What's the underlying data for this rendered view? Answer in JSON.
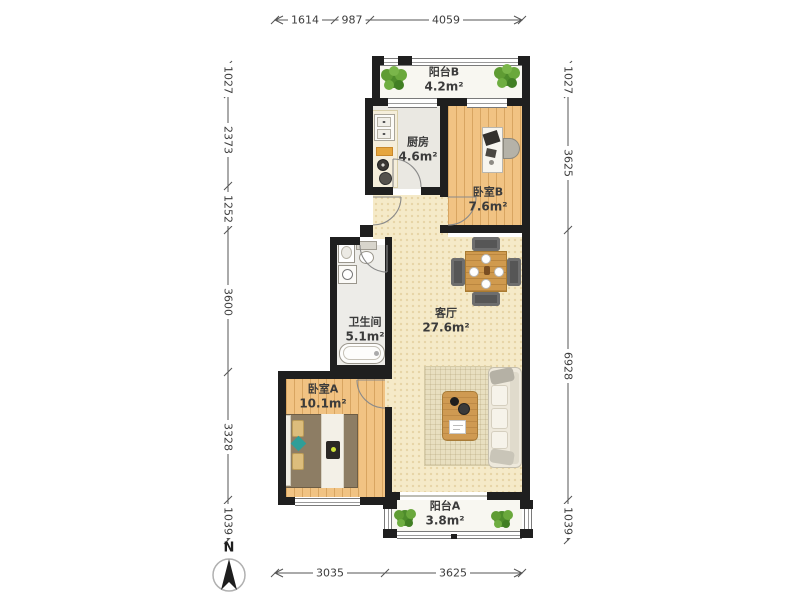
{
  "compass": {
    "label": "N"
  },
  "dimensions": {
    "top": [
      "1614",
      "987",
      "4059"
    ],
    "bottom": [
      "3035",
      "3625"
    ],
    "left": [
      "1027",
      "2373",
      "1252",
      "3600",
      "3328",
      "1039"
    ],
    "right": [
      "1027",
      "3625",
      "6928",
      "1039"
    ]
  },
  "rooms": {
    "balcony_b": {
      "name": "阳台B",
      "area": "4.2m²"
    },
    "kitchen": {
      "name": "厨房",
      "area": "4.6m²"
    },
    "bedroom_b": {
      "name": "卧室B",
      "area": "7.6m²"
    },
    "living_room": {
      "name": "客厅",
      "area": "27.6m²"
    },
    "bathroom": {
      "name": "卫生间",
      "area": "5.1m²"
    },
    "bedroom_a": {
      "name": "卧室A",
      "area": "10.1m²"
    },
    "balcony_a": {
      "name": "阳台A",
      "area": "3.8m²"
    }
  },
  "colors": {
    "wall": "#1f1f1f",
    "wood_floor": "#f1c383",
    "living_floor": "#f5eac8",
    "tile_floor": "#eae8e2",
    "balcony_floor": "#f8f7f1",
    "plant_green": "#4e8c2b",
    "dim_text": "#3d3d3d"
  }
}
